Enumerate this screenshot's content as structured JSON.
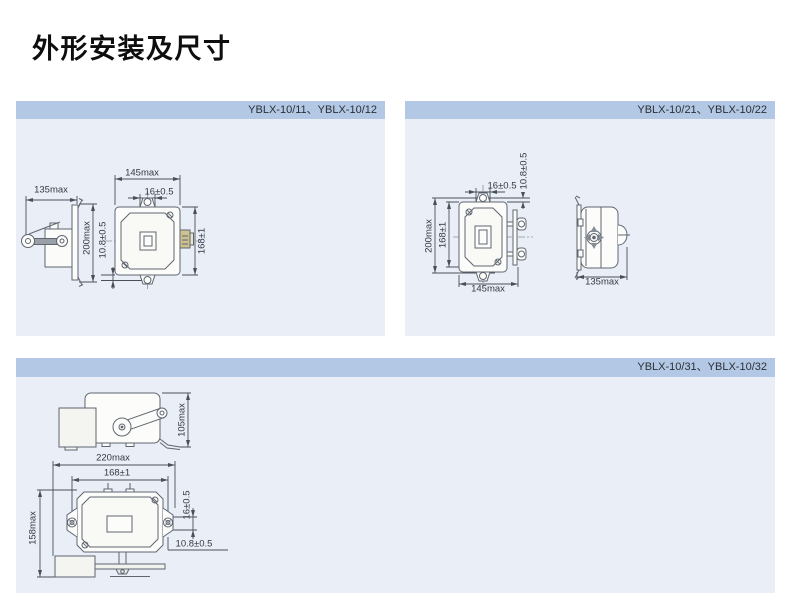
{
  "page": {
    "title": "外形安装及尺寸"
  },
  "colors": {
    "header_bar": "#b3c8e4",
    "panel_bg": "#e9eef7",
    "drawing_line": "#5f6670",
    "dimension_line": "#4a5058",
    "connector_beige": "#cec291"
  },
  "panels": [
    {
      "header": "YBLX-10/11、YBLX-10/12",
      "dims": {
        "side_width": "135max",
        "height": "200max",
        "front_width": "145max",
        "slot": "16±0.5",
        "hole_spacing": "168±1",
        "hole_offset": "10.8±0.5"
      }
    },
    {
      "header": "YBLX-10/21、YBLX-10/22",
      "dims": {
        "slot": "16±0.5",
        "hole_offset": "10.8±0.5",
        "height": "200max",
        "hole_spacing": "168±1",
        "front_width": "145max",
        "side_width": "135max"
      }
    },
    {
      "header": "YBLX-10/31、YBLX-10/32",
      "dims": {
        "lever_height": "105max",
        "total_width": "220max",
        "hole_spacing": "168±1",
        "total_height": "158max",
        "slot": "16±0.5",
        "hole_offset": "10.8±0.5"
      }
    }
  ]
}
